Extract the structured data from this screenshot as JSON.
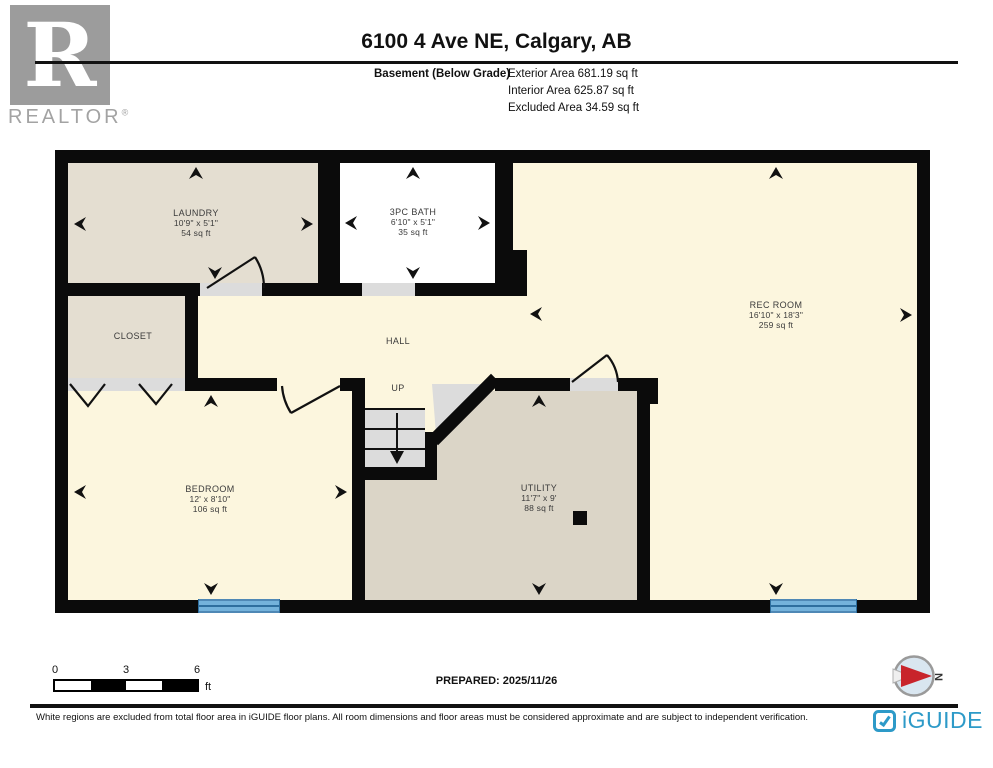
{
  "header": {
    "title": "6100 4 Ave NE, Calgary, AB",
    "floor_label": "Basement (Below Grade)",
    "exterior_area": "Exterior Area 681.19 sq ft",
    "interior_area": "Interior Area 625.87 sq ft",
    "excluded_area": "Excluded Area 34.59 sq ft",
    "logo_letter": "R",
    "logo_brand": "REALTOR",
    "logo_reg": "®"
  },
  "rooms": {
    "laundry": {
      "name": "LAUNDRY",
      "dims": "10'9\" x 5'1\"",
      "area": "54 sq ft"
    },
    "bath": {
      "name": "3PC BATH",
      "dims": "6'10\" x 5'1\"",
      "area": "35 sq ft"
    },
    "rec": {
      "name": "REC ROOM",
      "dims": "16'10\" x 18'3\"",
      "area": "259 sq ft"
    },
    "closet": {
      "name": "CLOSET"
    },
    "hall": {
      "name": "HALL"
    },
    "stairs": {
      "name": "UP"
    },
    "bedroom": {
      "name": "BEDROOM",
      "dims": "12' x 8'10\"",
      "area": "106 sq ft"
    },
    "utility": {
      "name": "UTILITY",
      "dims": "11'7\" x 9'",
      "area": "88 sq ft"
    }
  },
  "scale": {
    "tick0": "0",
    "tick1": "3",
    "tick2": "6",
    "unit": "ft"
  },
  "compass": {
    "north": "N"
  },
  "footer": {
    "prepared": "PREPARED: 2025/11/26",
    "disclaimer": "White regions are excluded from total floor area in iGUIDE floor plans. All room dimensions and floor areas must be considered approximate and are subject to independent verification.",
    "brand": "iGUIDE"
  },
  "colors": {
    "wall": "#0B0B0B",
    "cream_floor": "#FCF6DE",
    "beige_floor": "#E4DED1",
    "utility_floor": "#DBD5C7",
    "window_blue": "#74B2DB",
    "iguide_teal": "#2D9AC8",
    "compass_red": "#C8242B",
    "realtor_gray": "#9C9C9C"
  }
}
